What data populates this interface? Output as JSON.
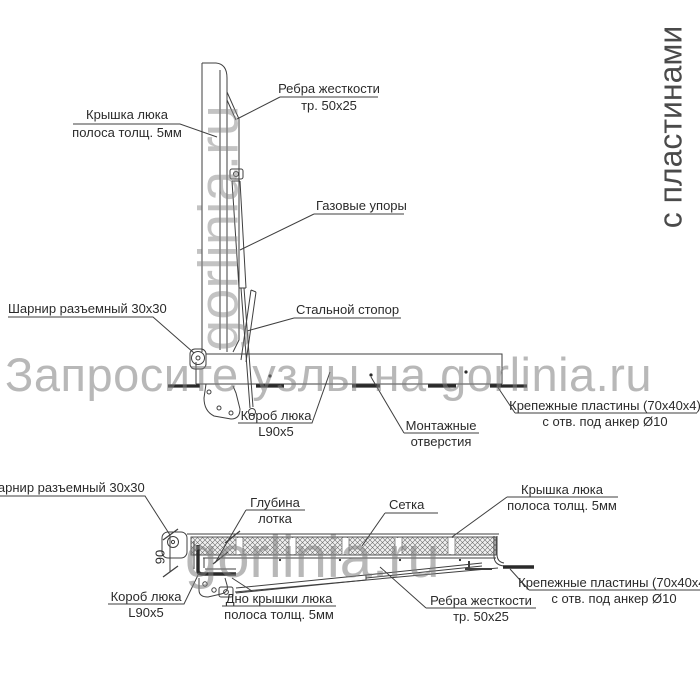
{
  "watermarks": {
    "main": "Запросите узлы на gorlinia.ru",
    "vertical_top": "gorlinia.ru",
    "horizontal_bottom": "gorlinia.ru",
    "side_note": "с пластинами"
  },
  "top_view": {
    "labels": {
      "lid": {
        "line1": "Крышка люка",
        "line2": "полоса толщ. 5мм"
      },
      "ribs": {
        "line1": "Ребра жесткости",
        "line2": "тр. 50x25"
      },
      "gas_struts": "Газовые упоры",
      "hinge": "Шарнир разъемный 30x30",
      "stopper": "Стальной стопор",
      "box": {
        "line1": "Короб люка",
        "line2": "L90x5"
      },
      "mounting_holes": {
        "line1": "Монтажные",
        "line2": "отверстия"
      },
      "plates": {
        "line1": "Крепежные пластины (70x40x4)",
        "line2": "с отв. под анкер Ø10"
      }
    }
  },
  "bottom_view": {
    "labels": {
      "hinge": "Шарнир разъемный 30x30",
      "tray_depth": {
        "line1": "Глубина",
        "line2": "лотка"
      },
      "mesh": "Сетка",
      "lid": {
        "line1": "Крышка люка",
        "line2": "полоса толщ. 5мм"
      },
      "depth_dim": "90",
      "box": {
        "line1": "Короб люка",
        "line2": "L90x5"
      },
      "lid_bottom": {
        "line1": "Дно крышки люка",
        "line2": "полоса толщ. 5мм"
      },
      "ribs": {
        "line1": "Ребра жесткости",
        "line2": "тр. 50x25"
      },
      "plates": {
        "line1": "Крепежные пластины (70x40x4)",
        "line2": "с отв. под анкер Ø10"
      }
    }
  },
  "colors": {
    "line": "#3f3f3f",
    "plate_line": "#2a2a2a",
    "watermark": "#7d7d7d",
    "label_text": "#2b2b2b"
  }
}
